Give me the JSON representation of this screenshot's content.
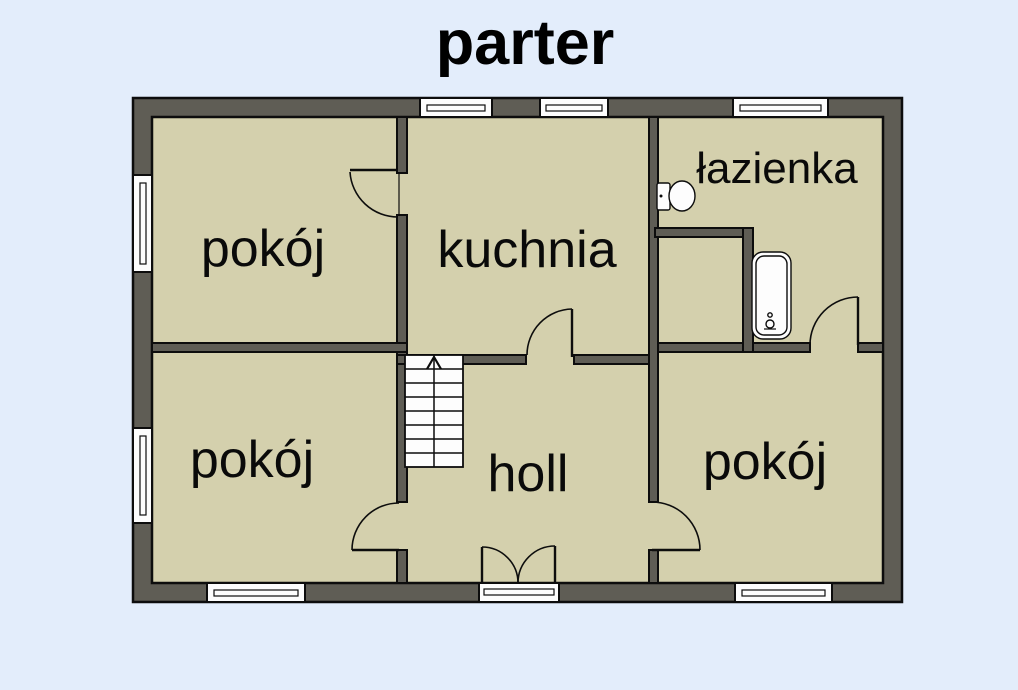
{
  "title": "parter",
  "colors": {
    "bg": "#e3edfb",
    "wall": "#5f5d55",
    "floor": "#d4d0ad",
    "line": "#0d0d0d",
    "fixture": "#fdfdfd"
  },
  "rooms": [
    {
      "label": "pokój",
      "position": "top-left"
    },
    {
      "label": "kuchnia",
      "position": "top-center"
    },
    {
      "label": "łazienka",
      "position": "top-right"
    },
    {
      "label": "pokój",
      "position": "bottom-left"
    },
    {
      "label": "holl",
      "position": "bottom-center"
    },
    {
      "label": "pokój",
      "position": "bottom-right"
    },
    {
      "label": "",
      "position": "closet-unlabeled"
    }
  ],
  "fixtures": [
    {
      "icon": "toilet-icon",
      "room": "łazienka"
    },
    {
      "icon": "bathtub-icon",
      "room": "łazienka"
    },
    {
      "icon": "staircase-up-icon",
      "room": "holl",
      "direction": "up"
    }
  ],
  "openings": {
    "windows": [
      "left-wall-upper",
      "left-wall-lower",
      "top-wall-kitchen-left",
      "top-wall-kitchen-right",
      "top-wall-bathroom",
      "bottom-wall-left-room",
      "bottom-wall-right-room"
    ],
    "doors": [
      "top-left-room-to-kitchen",
      "kitchen-to-hall",
      "entrance-double-door",
      "hall-to-bottom-left-room",
      "hall-to-bottom-right-room",
      "bathroom-to-bottom-right-room"
    ]
  }
}
